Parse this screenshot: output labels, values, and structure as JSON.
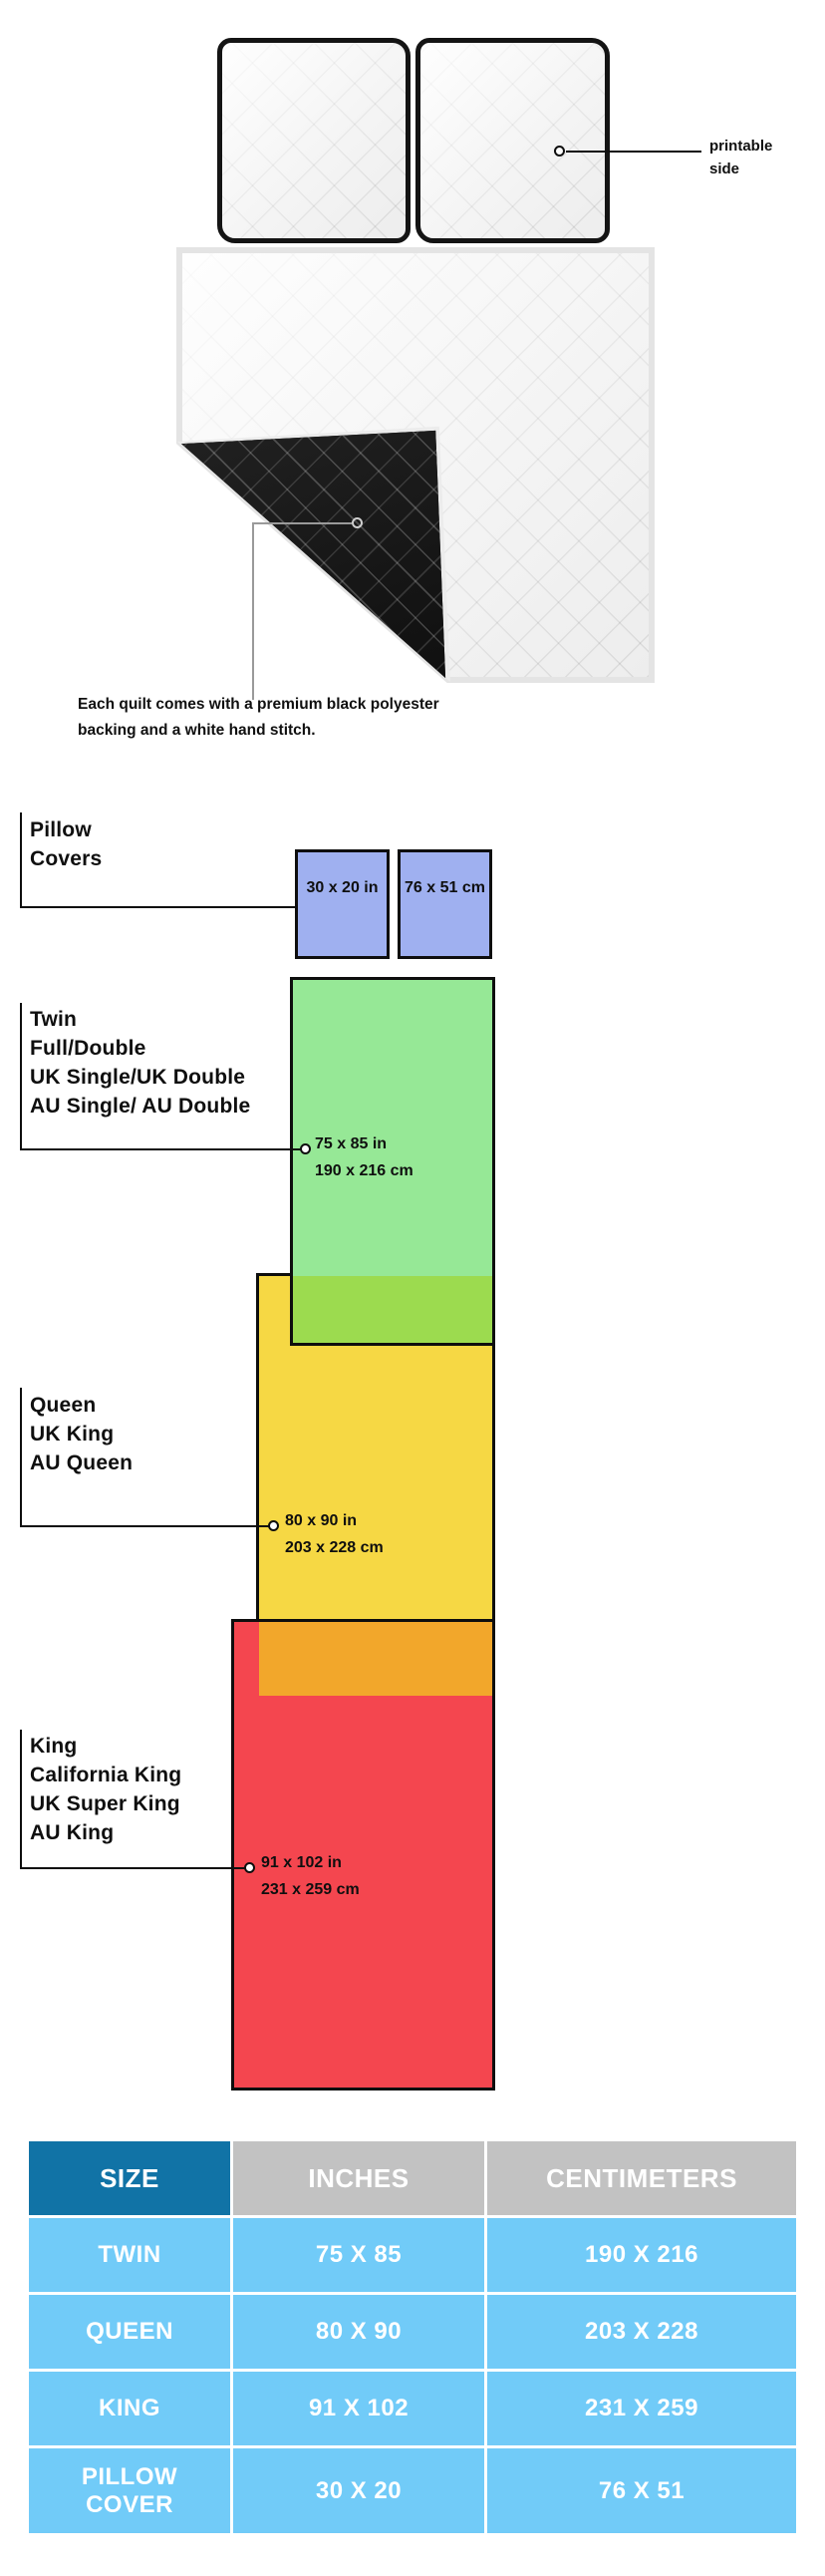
{
  "illustration": {
    "printable_side_label": "printable side",
    "backing_caption": "Each quilt comes with a premium black polyester backing and a white hand stitch.",
    "front_color": "#f6f6f6",
    "backing_color": "#171717"
  },
  "diagram": {
    "groups": [
      {
        "id": "pillow-covers",
        "label_lines": [
          "Pillow",
          "Covers"
        ],
        "size_in": "30 x 20 in",
        "size_cm": "76 x 51 cm",
        "color": "#9fb0f0"
      },
      {
        "id": "twin",
        "label_lines": [
          "Twin",
          "Full/Double",
          "UK Single/UK Double",
          "AU Single/ AU Double"
        ],
        "size_in": "75 x 85 in",
        "size_cm": "190 x 216 cm",
        "color": "#96e896"
      },
      {
        "id": "queen",
        "label_lines": [
          "Queen",
          "UK King",
          "AU Queen"
        ],
        "size_in": "80 x 90 in",
        "size_cm": "203 x 228 cm",
        "color": "#f6d844"
      },
      {
        "id": "king",
        "label_lines": [
          "King",
          "California King",
          "UK Super King",
          "AU King"
        ],
        "size_in": "91 x 102 in",
        "size_cm": "231 x 259 cm",
        "color": "#f4464f"
      }
    ],
    "overlap_colors": {
      "green_over_yellow": "#9cdb4f",
      "yellow_over_red": "#f2a72b"
    },
    "outline_color": "#0e0e0e"
  },
  "table": {
    "headers": [
      "SIZE",
      "INCHES",
      "CENTIMETERS"
    ],
    "header_colors": {
      "size": "#1173a6",
      "measure": "#c2c2c2"
    },
    "data_cell_color": "#71cbf8",
    "rows": [
      {
        "size": "TWIN",
        "inches": "75 X 85",
        "centimeters": "190 X 216",
        "color": "#90e78f"
      },
      {
        "size": "QUEEN",
        "inches": "80 X 90",
        "centimeters": "203 X 228",
        "color": "#f4d94a"
      },
      {
        "size": "KING",
        "inches": "91 X 102",
        "centimeters": "231 X 259",
        "color": "#f4454e"
      },
      {
        "size": "PILLOW\nCOVER",
        "inches": "30 X 20",
        "centimeters": "76 X 51",
        "color": "#7c87ef"
      }
    ]
  }
}
